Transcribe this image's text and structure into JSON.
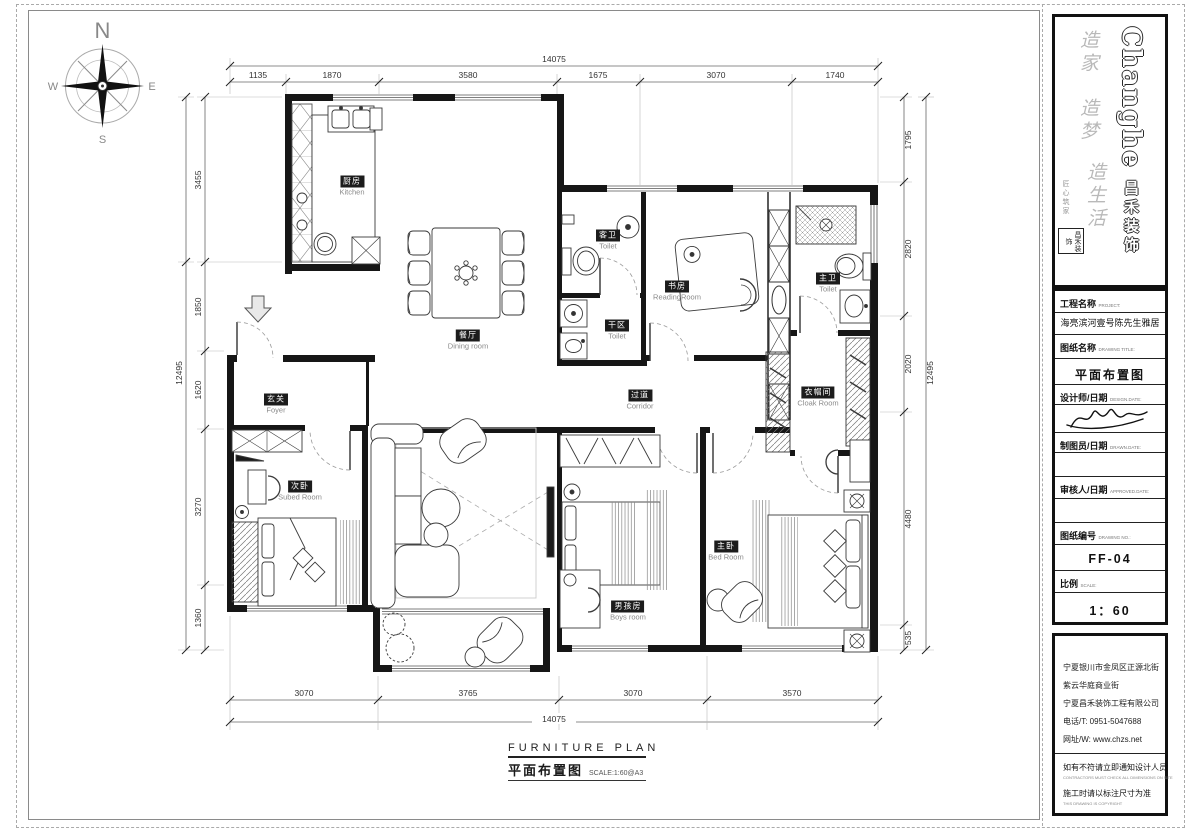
{
  "compass": {
    "n": "N",
    "e": "E",
    "s": "S",
    "w": "W"
  },
  "dimensions": {
    "top": {
      "overall": "14075",
      "segments": [
        "1135",
        "1870",
        "3580",
        "1675",
        "3070",
        "1740"
      ]
    },
    "bottom": {
      "overall": "14075",
      "segments": [
        "3070",
        "3765",
        "3070",
        "3570"
      ]
    },
    "left": {
      "overall": "12495",
      "segments": [
        "3455",
        "1850",
        "1620",
        "3270",
        "1360"
      ]
    },
    "right": {
      "overall": "12495",
      "segments": [
        "1795",
        "2820",
        "2020",
        "4480",
        "535"
      ]
    }
  },
  "rooms": [
    {
      "cn": "厨房",
      "en": "Kitchen"
    },
    {
      "cn": "餐厅",
      "en": "Dining room"
    },
    {
      "cn": "玄关",
      "en": "Foyer"
    },
    {
      "cn": "次卧",
      "en": "Subed Room"
    },
    {
      "cn": "过道",
      "en": "Corridor"
    },
    {
      "cn": "客卫",
      "en": "Toilet"
    },
    {
      "cn": "干区",
      "en": "Toilet"
    },
    {
      "cn": "书房",
      "en": "ReadingRoom"
    },
    {
      "cn": "主卫",
      "en": "Toilet"
    },
    {
      "cn": "衣帽间",
      "en": "Cloak Room"
    },
    {
      "cn": "男孩房",
      "en": "Boys room"
    },
    {
      "cn": "主卧",
      "en": "Bed Room"
    }
  ],
  "footer": {
    "title_en": "FURNITURE PLAN",
    "title_cn": "平面布置图",
    "scale_note": "SCALE:1:60@A3"
  },
  "title_block": {
    "brand": "Changhe",
    "brand_cn": "昌禾装饰",
    "slogan": [
      "造家",
      "造梦",
      "造生活"
    ],
    "side_note": "匠心筑家",
    "seal": "昌禾装饰",
    "project": {
      "label": "工程名称",
      "label_en": "PROJECT:",
      "value": "海亮滨河壹号陈先生雅居"
    },
    "drawing": {
      "label": "图纸名称",
      "label_en": "DRAWING TITLE:",
      "value": "平面布置图"
    },
    "designer": {
      "label": "设计师/日期",
      "label_en": "DESIGN.DATE:"
    },
    "drafter": {
      "label": "制图员/日期",
      "label_en": "DRAWN.DATE:"
    },
    "approver": {
      "label": "审核人/日期",
      "label_en": "APPROVED.DATE:"
    },
    "number": {
      "label": "图纸编号",
      "label_en": "DRAWING NO.:",
      "value": "FF-04"
    },
    "scale": {
      "label": "比例",
      "label_en": "SCALE:",
      "value": "1：60"
    }
  },
  "address": {
    "lines": [
      "宁夏银川市金凤区正源北街",
      "紫云华庭商业街",
      "宁夏昌禾装饰工程有限公司",
      "电话/T: 0951-5047688",
      "网址/W: www.chzs.net"
    ],
    "notes": [
      {
        "cn": "如有不符请立即通知设计人员",
        "en": "CONTRACTORS MUST CHECK ALL DIMENSIONS ON SITE"
      },
      {
        "cn": "施工时请以标注尺寸为准",
        "en": "THIS DRAWING IS COPYRIGHT"
      }
    ]
  }
}
